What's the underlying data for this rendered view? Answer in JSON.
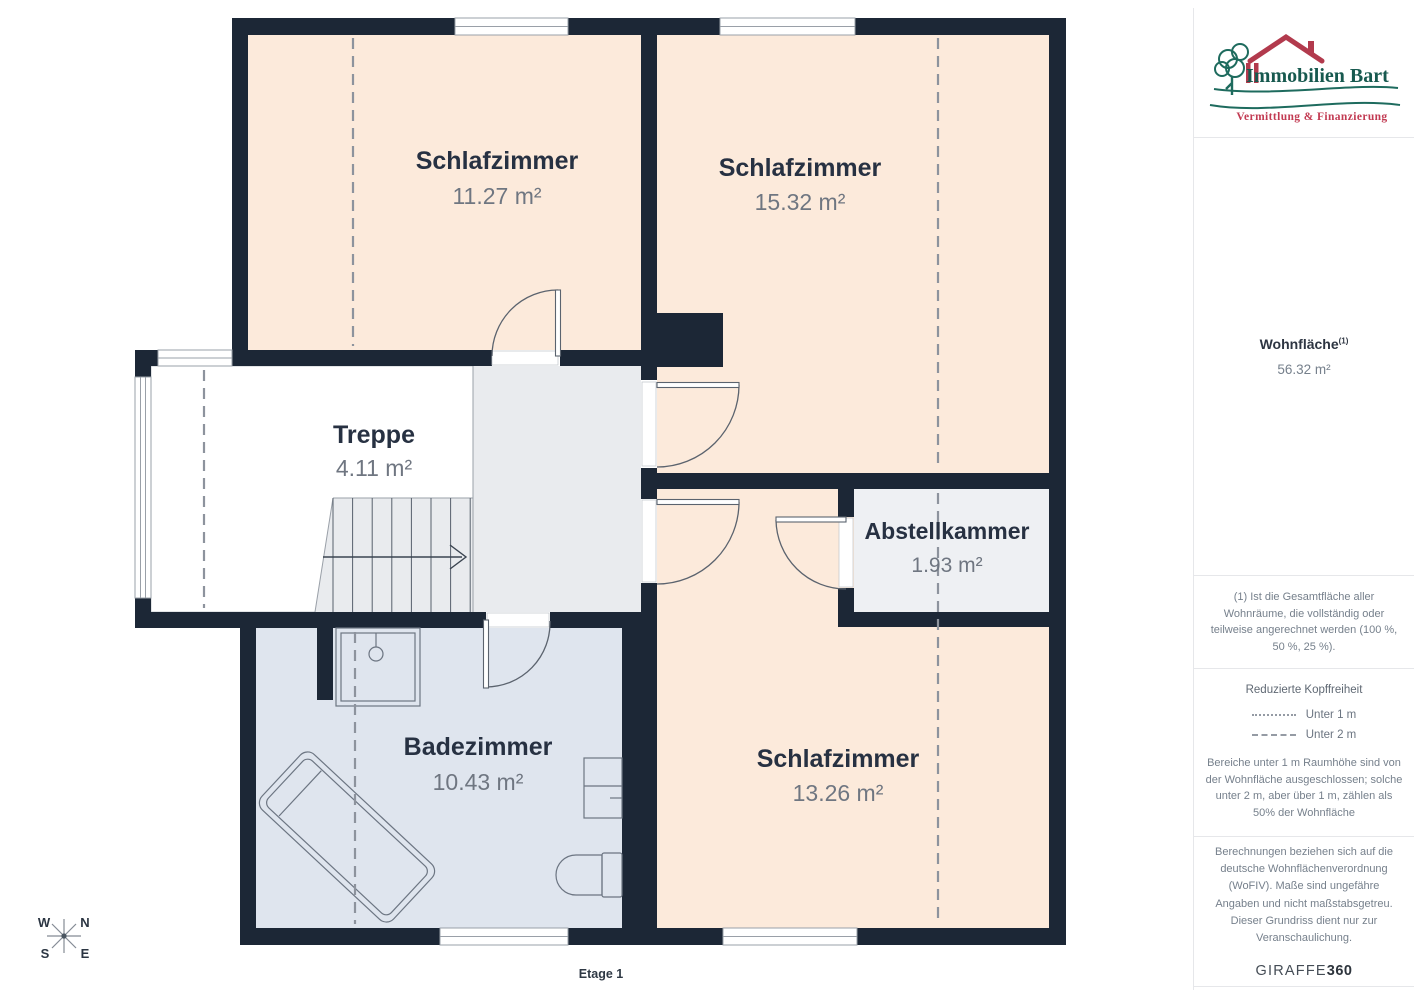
{
  "floorplan": {
    "rooms": [
      {
        "name": "Schlafzimmer",
        "area": "11.27 m²"
      },
      {
        "name": "Schlafzimmer",
        "area": "15.32 m²"
      },
      {
        "name": "Treppe",
        "area": "4.11 m²"
      },
      {
        "name": "Abstellkammer",
        "area": "1.93 m²"
      },
      {
        "name": "Badezimmer",
        "area": "10.43 m²"
      },
      {
        "name": "Schlafzimmer",
        "area": "13.26 m²"
      }
    ],
    "floor_label": "Etage 1",
    "compass": {
      "n": "N",
      "e": "E",
      "s": "S",
      "w": "W"
    }
  },
  "sidebar": {
    "logo": {
      "title": "Immobilien Bart",
      "subtitle": "Vermittlung & Finanzierung"
    },
    "living_area": {
      "label": "Wohnfläche",
      "sup": "(1)",
      "value": "56.32 m²"
    },
    "footnote": "(1) Ist die Gesamtfläche aller Wohnräume, die vollständig oder teilweise angerechnet werden (100 %, 50 %, 25 %).",
    "headroom": {
      "title": "Reduzierte Kopffreiheit",
      "legend": [
        {
          "style": "dotted",
          "label": "Unter 1 m"
        },
        {
          "style": "dashed",
          "label": "Unter 2 m"
        }
      ],
      "note": "Bereiche unter 1 m Raumhöhe sind von der Wohnfläche ausgeschlossen; solche unter 2 m, aber über 1 m, zählen als 50% der Wohnfläche"
    },
    "disclaimer": "Berechnungen beziehen sich auf die deutsche Wohnflächenverordnung (WoFIV). Maße sind ungefähre Angaben und nicht maßstabsgetreu. Dieser Grundriss dient nur zur Veranschaulichung.",
    "brand": {
      "name": "GIRAFFE",
      "suffix": "360"
    }
  },
  "colors": {
    "wall": "#1c2736",
    "room_warm": "#fceadb",
    "room_bath": "#dfe5ee",
    "hall": "#e9ebee",
    "storage": "#eef0f3",
    "logo_green": "#1e6b5e",
    "logo_red": "#b23a4d",
    "text_dark": "#273142",
    "text_gray": "#6f7681"
  }
}
